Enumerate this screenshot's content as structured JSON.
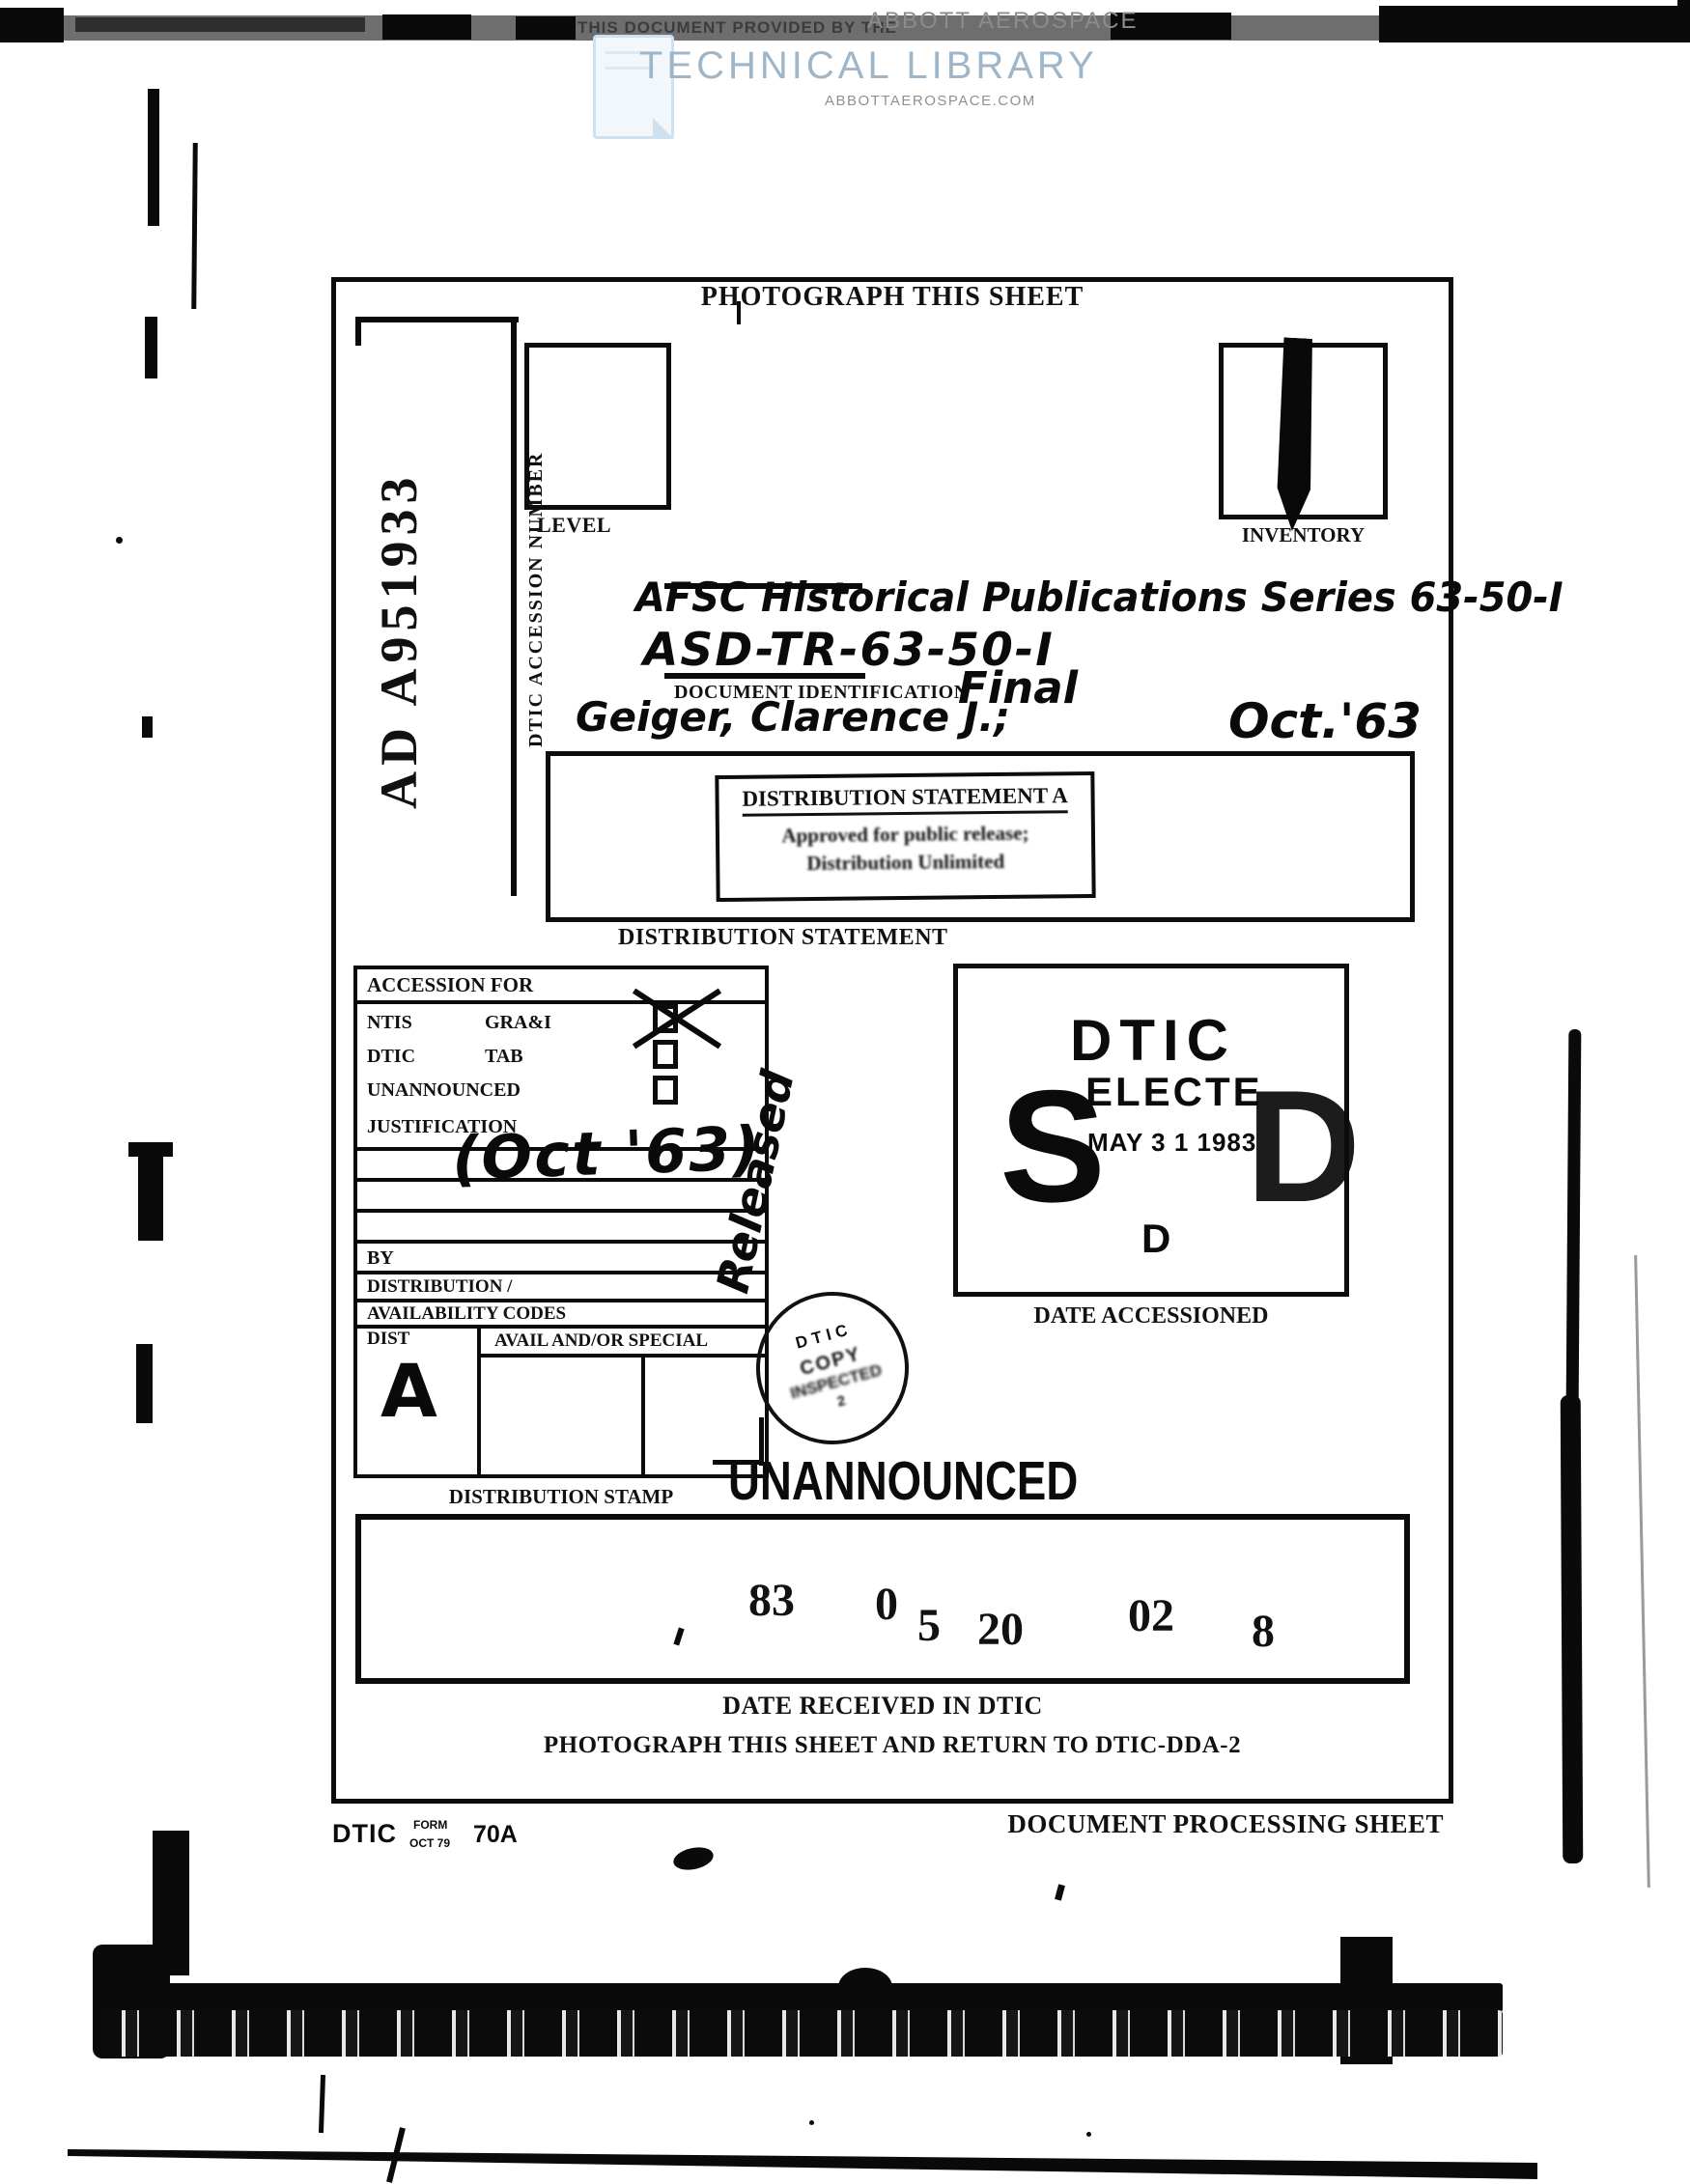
{
  "banner": {
    "provided_by": "THIS DOCUMENT PROVIDED BY THE",
    "provider": "ABBOTT AEROSPACE",
    "title": "TECHNICAL LIBRARY",
    "url": "ABBOTTAEROSPACE.COM",
    "title_color": "#9fb6c9",
    "band_color": "#6e6e6e"
  },
  "sheet": {
    "header": "PHOTOGRAPH THIS SHEET",
    "ad_number": "AD A951933",
    "ad_number_label": "DTIC ACCESSION NUMBER",
    "level_label": "LEVEL",
    "inventory_label": "INVENTORY",
    "doc_id": {
      "handwritten_line1": "AFSC Historical Publications Series 63-50-I",
      "handwritten_line2": "ASD-TR-63-50-I",
      "label": "DOCUMENT IDENTIFICATION",
      "handwritten_type": "Final",
      "handwritten_author": "Geiger, Clarence J.;",
      "handwritten_date": "Oct.'63"
    },
    "distribution": {
      "stamp_title": "DISTRIBUTION STATEMENT A",
      "stamp_line1": "Approved for public release;",
      "stamp_line2": "Distribution Unlimited",
      "label": "DISTRIBUTION STATEMENT"
    },
    "accession": {
      "header": "ACCESSION FOR",
      "row1_left": "NTIS",
      "row1_right": "GRA&I",
      "row1_checked": "yes",
      "row2_left": "DTIC",
      "row2_right": "TAB",
      "row2_checked": "no",
      "row3": "UNANNOUNCED",
      "row3_checked": "no",
      "row4": "JUSTIFICATION",
      "handwritten_note": "(Oct '63)",
      "by": "BY",
      "dist_slash": "DISTRIBUTION /",
      "avail_codes": "AVAILABILITY CODES",
      "dist": "DIST",
      "avail_special": "AVAIL AND/OR SPECIAL",
      "handwritten_dist": "A",
      "label": "DISTRIBUTION STAMP"
    },
    "dtic_stamp": {
      "s": "S",
      "dtic": "DTIC",
      "electe": "ELECTE",
      "date": "MAY 3 1 1983",
      "d": "D",
      "small_d": "D",
      "label": "DATE ACCESSIONED"
    },
    "round_stamp": {
      "l1": "DTIC",
      "l2": "COPY",
      "l3": "INSPECTED",
      "l4": "2"
    },
    "released": "Released",
    "unannounced": "UNANNOUNCED",
    "received": {
      "d1": "83",
      "d2": "0",
      "d3": "5",
      "d4": "20",
      "d5": "02",
      "d6": "8",
      "label": "DATE RECEIVED IN DTIC"
    },
    "return_note": "PHOTOGRAPH THIS SHEET AND RETURN TO DTIC-DDA-2",
    "footer": {
      "org": "DTIC",
      "form": "FORM",
      "form_date": "OCT 79",
      "number": "70A",
      "label": "DOCUMENT PROCESSING SHEET"
    }
  }
}
